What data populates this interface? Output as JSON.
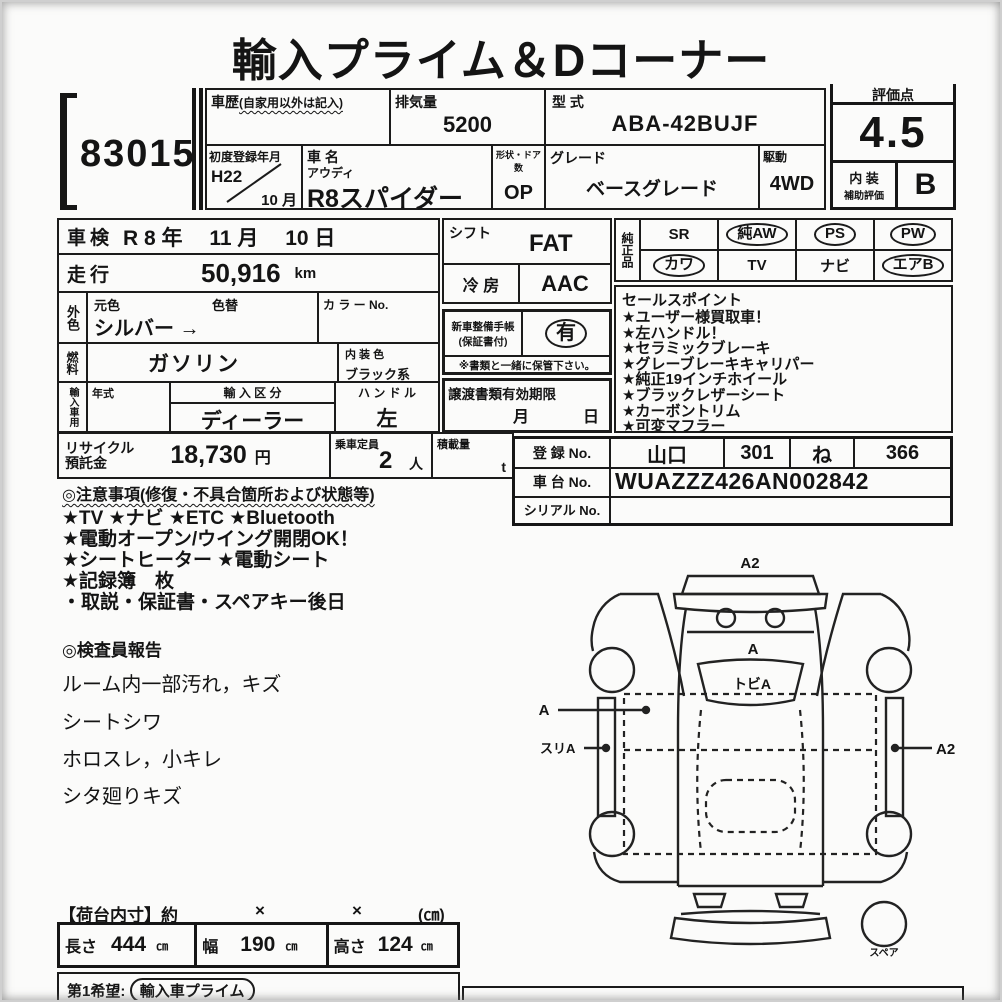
{
  "page": {
    "title": "輸入プライム＆Dコーナー",
    "lot_number": "83015"
  },
  "header": {
    "history_label": "車歴",
    "history_note": "(自家用以外は記入)",
    "displacement_label": "排気量",
    "displacement_value": "5200",
    "model_code_label": "型 式",
    "model_code_value": "ABA-42BUJF",
    "first_reg_label": "初度登録年月",
    "first_reg_year": "H22",
    "first_reg_month": "10 月",
    "car_name_label": "車 名",
    "car_maker": "アウディ",
    "car_name": "R8スパイダー",
    "shape_doors_label": "形状・ドア数",
    "shape_doors_value": "OP",
    "grade_label": "グレード",
    "grade_value": "ベースグレード",
    "drive_label": "駆動",
    "drive_value": "4WD"
  },
  "rating": {
    "score_label": "評価点",
    "score": "4.5",
    "interior_line1": "内 装",
    "interior_line2": "補助評価",
    "interior_grade": "B"
  },
  "vehicle": {
    "shaken_label": "車検",
    "shaken_value": "R 8 年　 11 月　 10 日",
    "mileage_label": "走行",
    "mileage_value": "50,916",
    "mileage_unit": "km",
    "ext_color_label": "外色",
    "orig_color_label": "元色",
    "recolor_label": "色替",
    "color_value": "シルバー →",
    "color_no_label": "カ ラ ー No.",
    "fuel_label": "燃料",
    "fuel_value": "ガソリン",
    "int_color_label": "内 装 色",
    "int_color_value": "ブラック系",
    "import_label": "輸入車用",
    "year_label": "年式",
    "import_class_label": "輸 入 区 分",
    "import_class_value": "ディーラー",
    "handle_label": "ハ ン ド ル",
    "handle_value": "左"
  },
  "equipment": {
    "shift_label": "シフト",
    "shift_value": "FAT",
    "ac_label": "冷 房",
    "ac_value": "AAC",
    "service_book_label1": "新車整備手帳",
    "service_book_label2": "(保証書付)",
    "service_book_value": "有",
    "keep_note": "※書類と一緒に保管下さい。",
    "transfer_label": "譲渡書類有効期限",
    "transfer_month": "月",
    "transfer_day": "日"
  },
  "oem": {
    "label": "純正品",
    "items": [
      {
        "label": "SR",
        "circled": false
      },
      {
        "label": "純AW",
        "circled": true
      },
      {
        "label": "PS",
        "circled": true
      },
      {
        "label": "PW",
        "circled": true
      },
      {
        "label": "カワ",
        "circled": true
      },
      {
        "label": "TV",
        "circled": false
      },
      {
        "label": "ナビ",
        "circled": false
      },
      {
        "label": "エアB",
        "circled": true
      }
    ]
  },
  "sales_points": {
    "title": "セールスポイント",
    "items": [
      "★ユーザー様買取車！",
      "★左ハンドル！",
      "★セラミックブレーキ",
      "★グレーブレーキキャリパー",
      "★純正19インチホイール",
      "★ブラックレザーシート",
      "★カーボントリム",
      "★可変マフラー"
    ]
  },
  "recycle": {
    "label1": "リサイクル",
    "label2": "預託金",
    "value": "18,730",
    "unit": "円",
    "capacity_label": "乗車定員",
    "capacity_value": "2",
    "capacity_unit": "人",
    "load_label": "積載量",
    "load_unit": "t"
  },
  "registration": {
    "reg_label": "登 録 No.",
    "reg_region": "山口",
    "reg_class": "301",
    "reg_kana": "ね",
    "reg_number": "366",
    "chassis_label": "車 台 No.",
    "chassis_value": "WUAZZZ426AN002842",
    "serial_label": "シリアル No."
  },
  "notes": {
    "title": "◎注意事項(修復・不具合箇所および状態等)",
    "items": [
      "★TV ★ナビ ★ETC ★Bluetooth",
      "★電動オープン/ウイング開閉OK！",
      "★シートヒーター ★電動シート",
      "★記録簿　枚",
      "・取説・保証書・スペアキー後日"
    ]
  },
  "inspection": {
    "title": "◎検査員報告",
    "items": [
      "ルーム内一部汚れ，キズ",
      "シートシワ",
      "ホロスレ，小キレ",
      "シタ廻りキズ"
    ]
  },
  "diagram": {
    "front_label": "A2",
    "hood_label": "A",
    "windshield_label": "トビA",
    "left_label": "A",
    "left_sill_label": "スリA",
    "right_label": "A2",
    "spare_label": "スペア"
  },
  "cargo": {
    "title": "【荷台内寸】約",
    "x1": "×",
    "x2": "×",
    "unit": "(㎝)",
    "length_label": "長さ",
    "length_value": "444",
    "length_unit": "㎝",
    "width_label": "幅",
    "width_value": "190",
    "width_unit": "㎝",
    "height_label": "高さ",
    "height_value": "124",
    "height_unit": "㎝"
  },
  "footer": {
    "wish_label": "第1希望:",
    "wish_value": "輸入車プライム"
  }
}
